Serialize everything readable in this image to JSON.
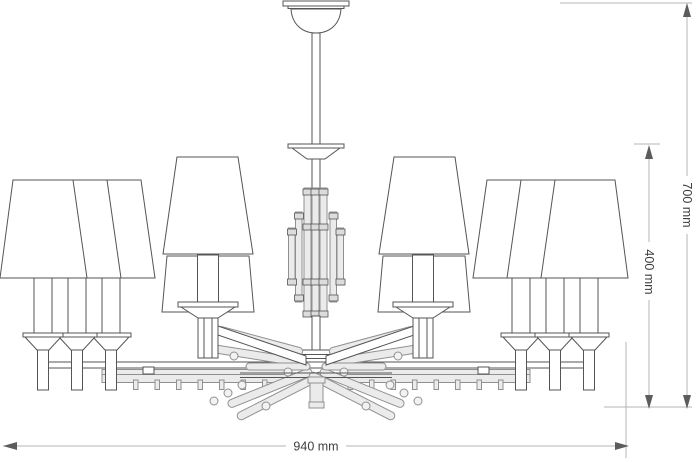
{
  "drawing": {
    "type": "technical-line-drawing",
    "subject": "eight-arm chandelier elevation with dimensions"
  },
  "dimensions": {
    "width": "940 mm",
    "overall_height": "700 mm",
    "body_height": "400 mm"
  },
  "colors": {
    "bg": "#ffffff",
    "line": "#555555",
    "line-light": "#909090",
    "fill-white": "#ffffff",
    "fill-crystal": "#ebebeb",
    "fill-metal": "#dcdcdc",
    "fill-bead": "#f2f2f2",
    "dim-line": "#b5b5b5",
    "arrow": "#5c5c5c",
    "dim-text": "#3d3d3d"
  }
}
